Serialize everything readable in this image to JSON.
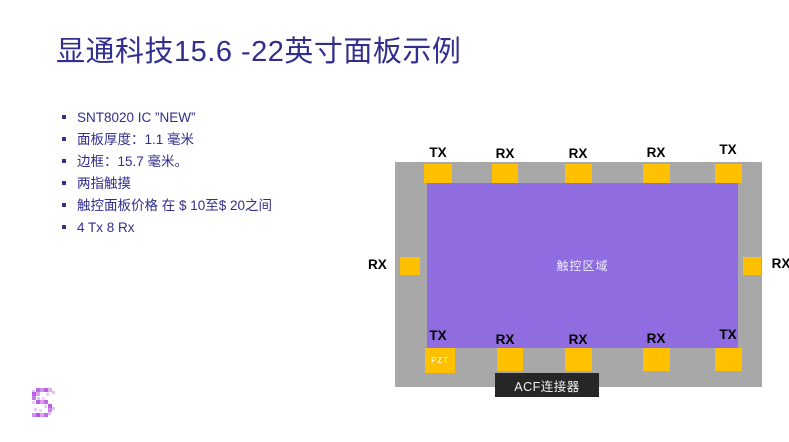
{
  "slide": {
    "title": "显通科技15.6 -22英寸面板示例",
    "bullets": [
      "SNT8020 IC ”NEW”",
      "面板厚度：1.1 毫米",
      "边框：15.7 毫米。",
      "两指触摸",
      "触控面板价格 在 $ 10至$ 20之间",
      "4 Tx 8 Rx"
    ]
  },
  "diagram": {
    "panel_top_labels": [
      "TX",
      "RX",
      "RX",
      "RX",
      "TX"
    ],
    "panel_bottom_labels": [
      "TX",
      "RX",
      "RX",
      "RX",
      "TX"
    ],
    "panel_left_label": "RX",
    "panel_right_label": "RX",
    "touch_area_label": "触控区域",
    "pzt_label": "PZT",
    "acf_label": "ACF连接器"
  },
  "colors": {
    "title_text": "#312e8e",
    "panel_gray": "#a8a8a8",
    "touch_area_purple": "#8f6ce0",
    "pad_orange": "#ffc000",
    "acf_box_dark": "#262626",
    "logo_purple": "#b75ce6"
  }
}
